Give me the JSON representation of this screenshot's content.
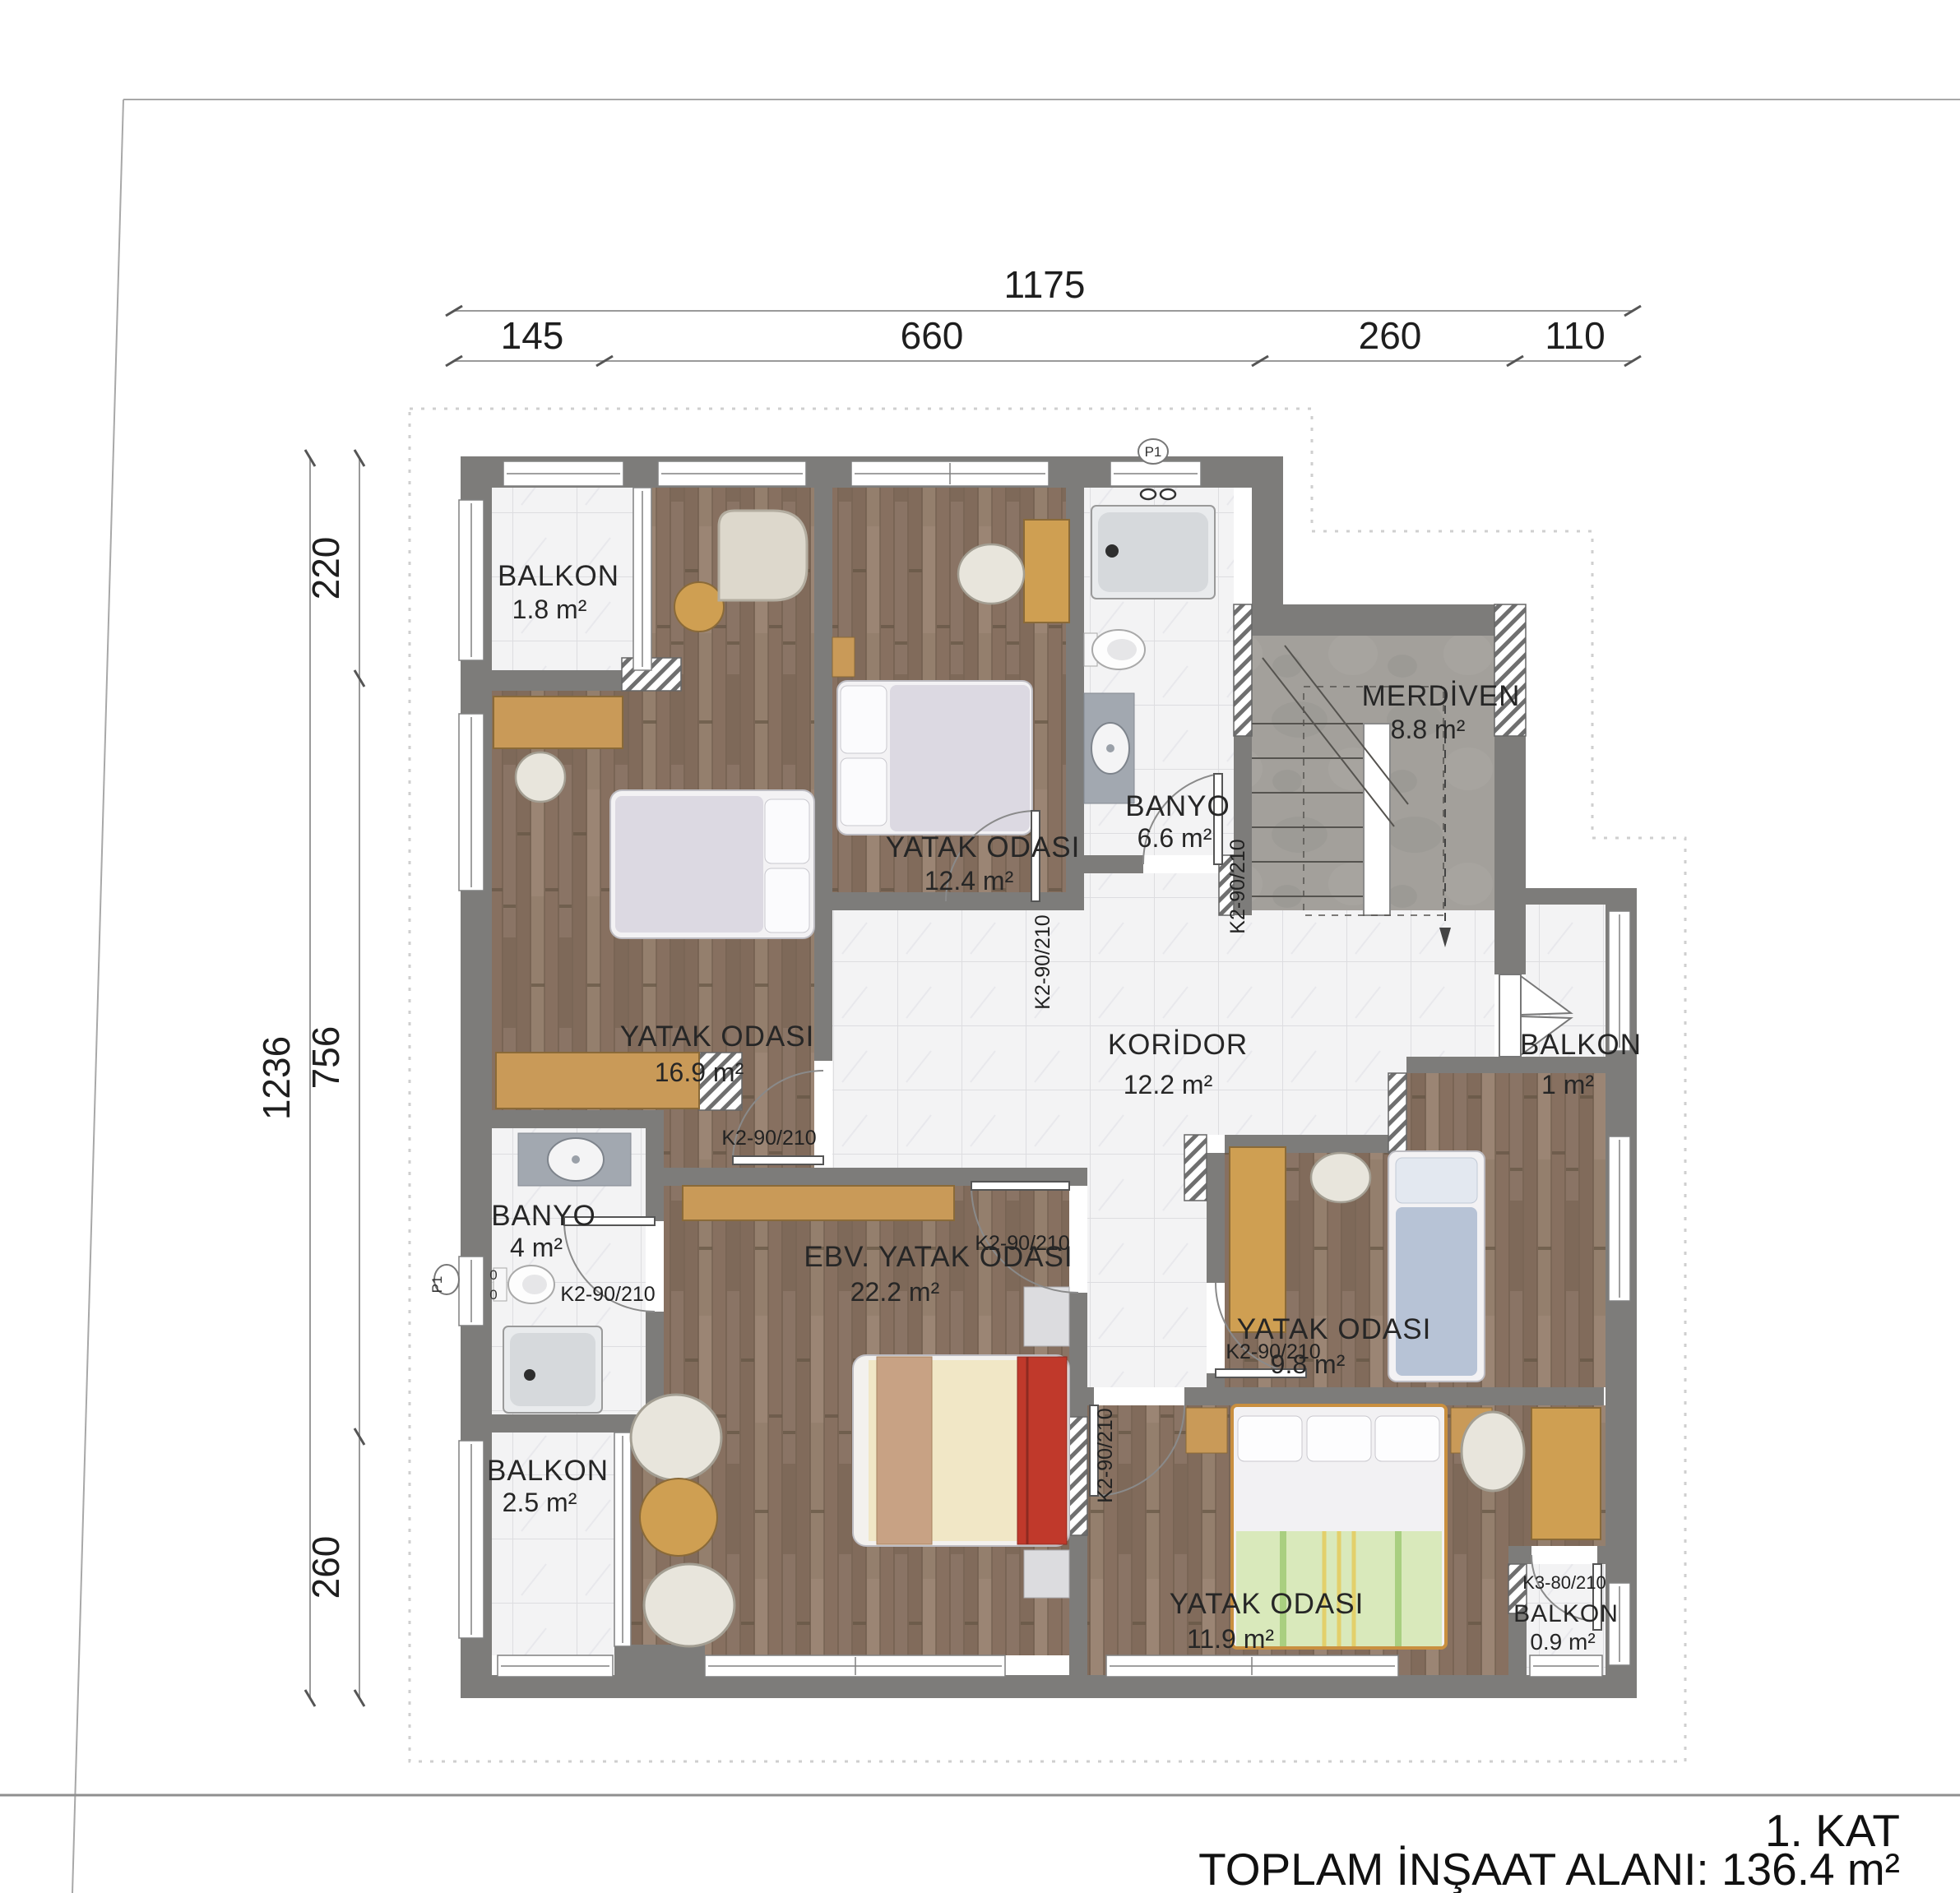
{
  "title": {
    "floor_label": "1. KAT",
    "total_area_label": "TOPLAM İNŞAAT ALANI: 136.4 m²"
  },
  "dimensions": {
    "top": {
      "total": "1175",
      "segments": [
        "145",
        "660",
        "260",
        "110"
      ]
    },
    "left": {
      "total": "1236",
      "segments": [
        "220",
        "756",
        "260"
      ]
    }
  },
  "rooms": {
    "balkon18": {
      "name": "BALKON",
      "area": "1.8 m²"
    },
    "bedroom16": {
      "name": "YATAK ODASI",
      "area": "16.9 m²"
    },
    "bedroom12": {
      "name": "YATAK ODASI",
      "area": "12.4 m²"
    },
    "banyo66": {
      "name": "BANYO",
      "area": "6.6 m²"
    },
    "merdiven": {
      "name": "MERDİVEN",
      "area": "8.8 m²"
    },
    "koridor": {
      "name": "KORİDOR",
      "area": "12.2 m²"
    },
    "balkon1": {
      "name": "BALKON",
      "area": "1 m²"
    },
    "banyo4": {
      "name": "BANYO",
      "area": "4 m²"
    },
    "master": {
      "name": "EBV. YATAK ODASI",
      "area": "22.2 m²"
    },
    "bedroom98": {
      "name": "YATAK ODASI",
      "area": "9.8 m²"
    },
    "bedroom119": {
      "name": "YATAK ODASI",
      "area": "11.9 m²"
    },
    "balkon25": {
      "name": "BALKON",
      "area": "2.5 m²"
    },
    "balkon09": {
      "name": "BALKON",
      "area": "0.9 m²"
    }
  },
  "doors": {
    "k2": "K2-90/210",
    "k3": "K3-80/210"
  },
  "markers": {
    "p1": "P1",
    "zero": "0"
  },
  "colors": {
    "wall": "#7d7c7a",
    "wood_floor": "#8b7566",
    "tile_floor": "#f3f3f4",
    "concrete": "#a3a09b",
    "furniture_tan": "#c99a58",
    "accent_red": "#c0392b",
    "bed_blue": "#b7c3d6",
    "blanket_green": "#d9e9bb",
    "blanket_cream": "#f1e7c6"
  }
}
